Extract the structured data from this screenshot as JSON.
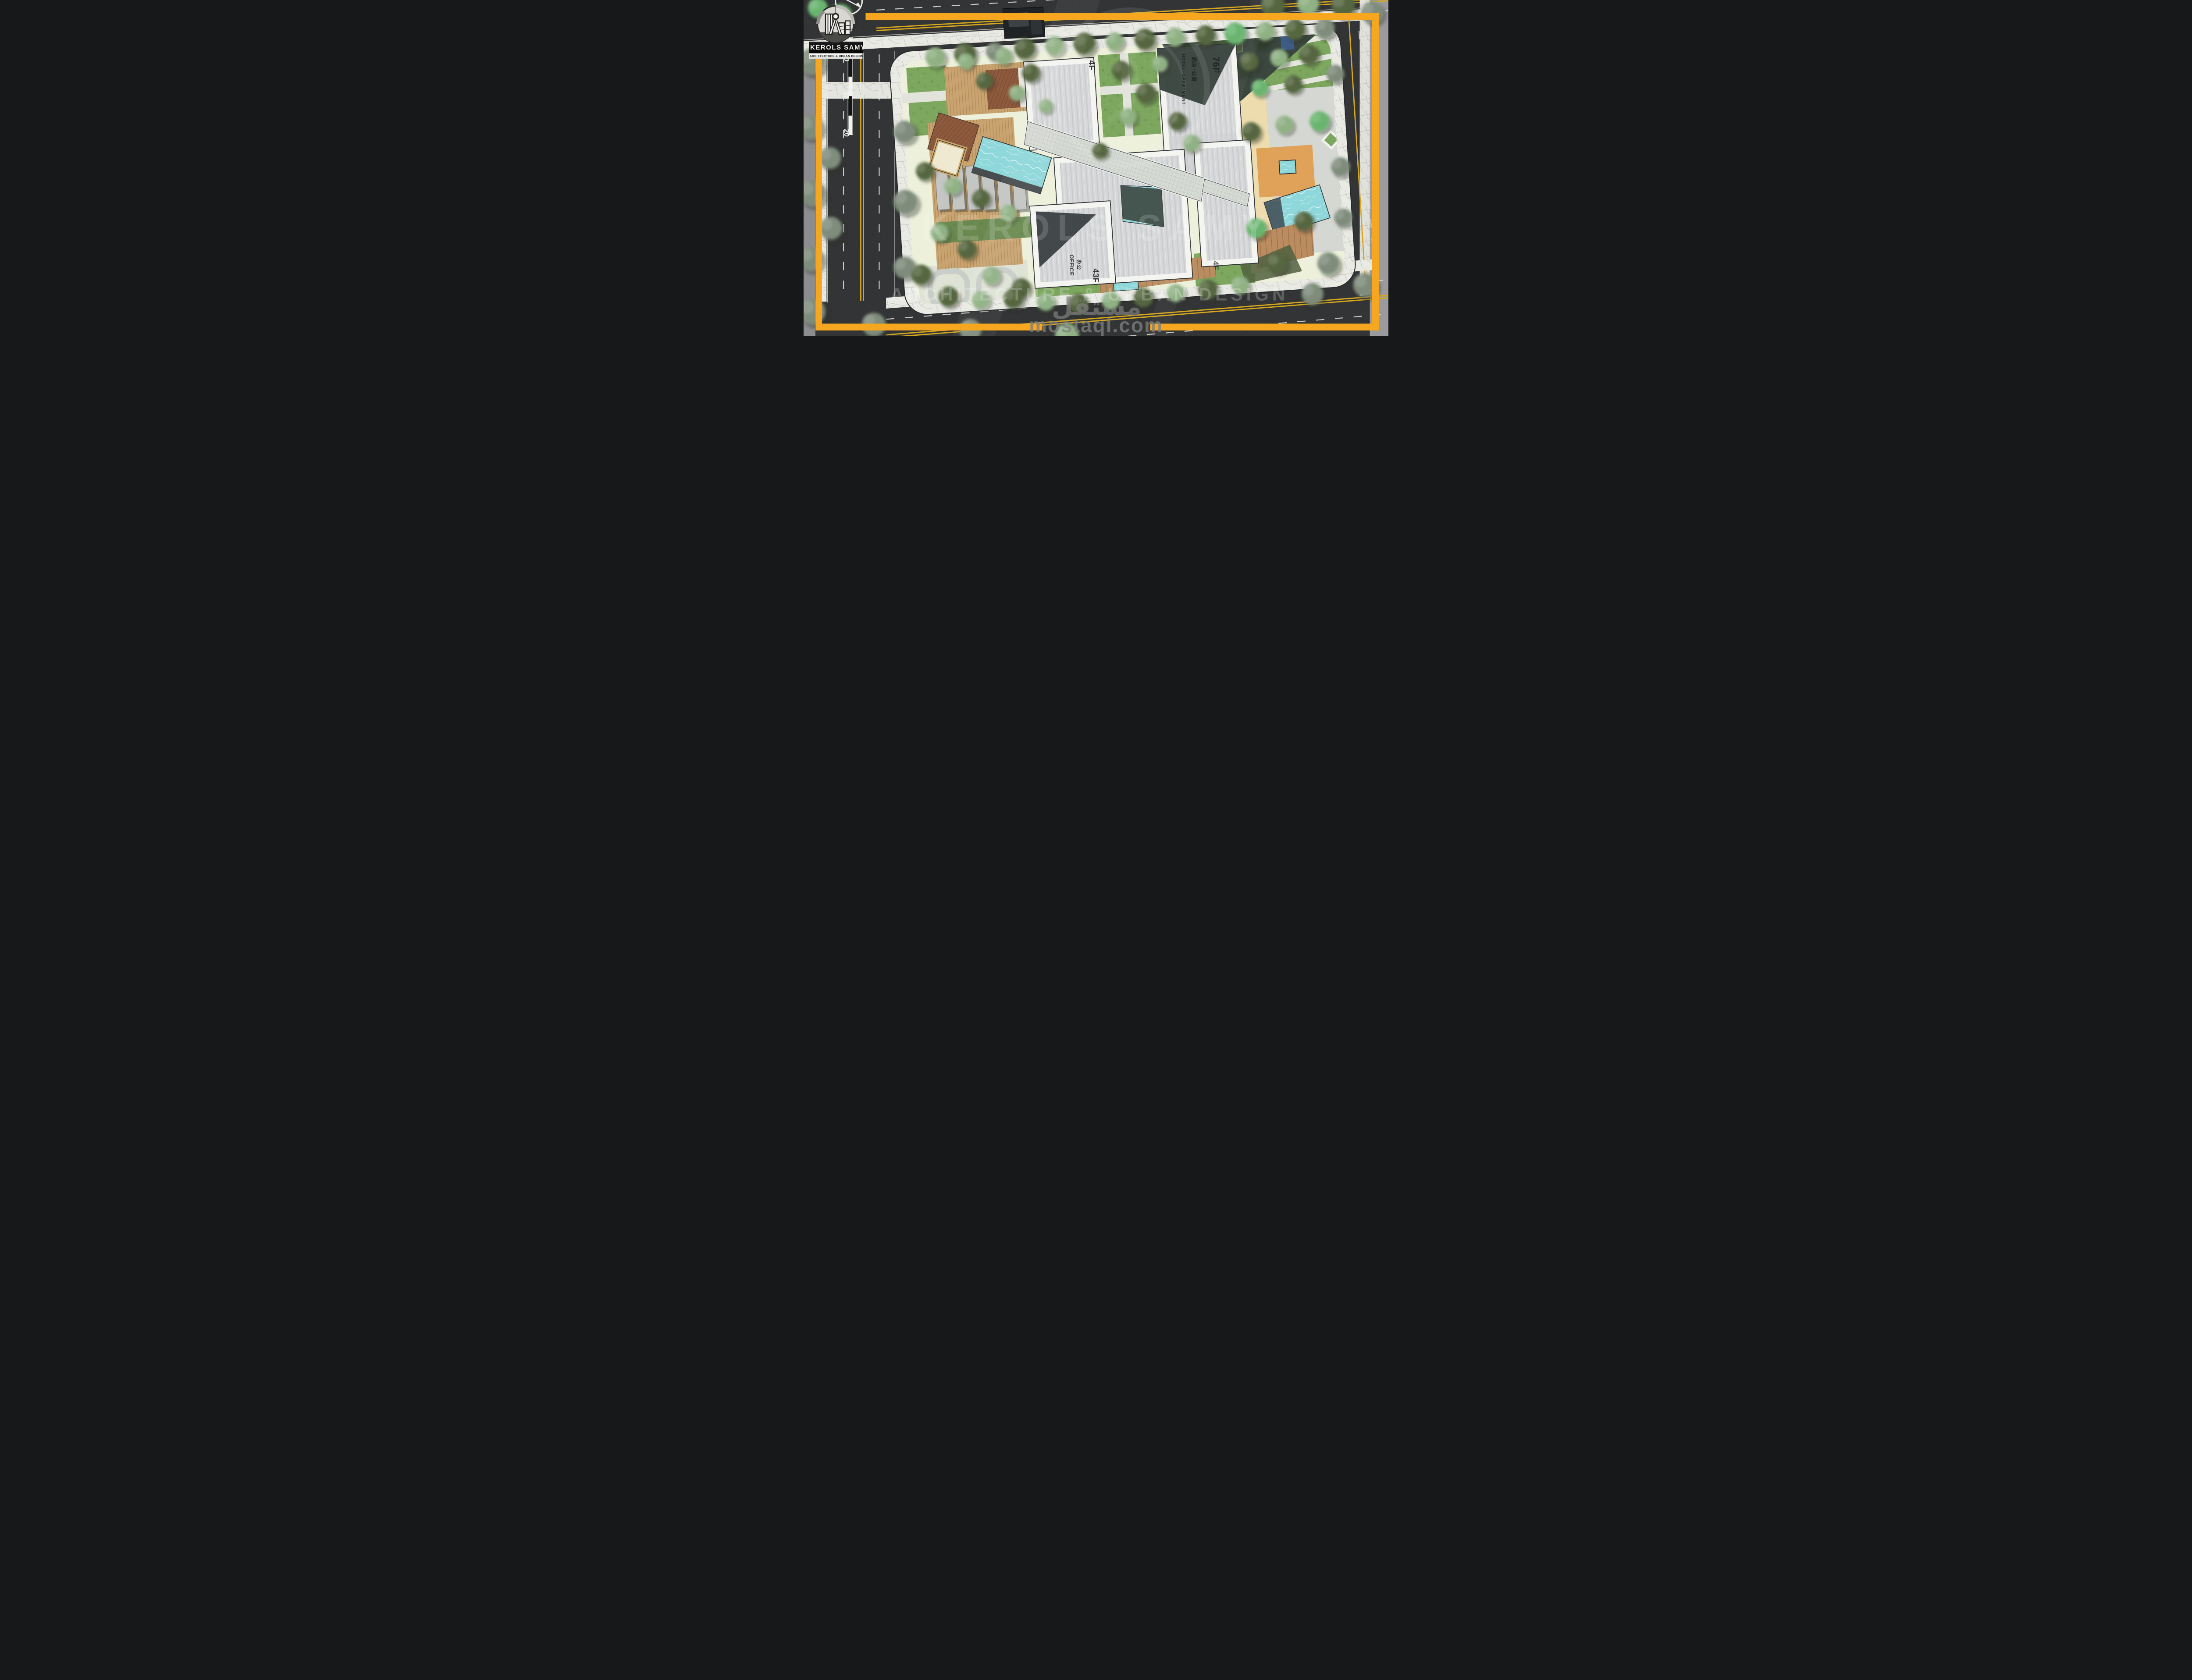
{
  "title": "Mixed-use masterplan site plan rendering",
  "logo": {
    "name": "KEROLS SAMY",
    "tagline": "ARCHITECTURE & URBAN DESIGN"
  },
  "scale_bar": {
    "ticks": [
      "10",
      "15",
      "20"
    ]
  },
  "buildings": {
    "retail_north": {
      "floors": "4F"
    },
    "hotel_apartment": {
      "floors": "76F",
      "use_en": "HOTEL+APARTMENT",
      "use_zh": "酒店+公寓"
    },
    "office": {
      "floors": "43F",
      "use_en": "OFFICE",
      "use_zh": "办公"
    },
    "east_podium": {
      "floors": "4F"
    }
  },
  "watermarks": {
    "brand": "KEROLS SAMY",
    "brand_tagline": "ARCHITECTURE & URBAN DESIGN",
    "marketplace_ar": "مستقل",
    "marketplace_url": "mostaql.com"
  },
  "theme": {
    "accent_orange": "#F7A71F",
    "asphalt": "#2A2C2D",
    "site_ground": "#EDF1DB",
    "sidewalk": "#E9EAE4",
    "grass": "#7DA75F",
    "hedge": "#55663F",
    "water": "#8ED7DA",
    "roof_gray": "#D6D7D8",
    "dark_tower": "#3A463E",
    "wood_tan": "#C9A470",
    "wood_red": "#8E5A3E",
    "sand": "#ECDCAE",
    "sand_orange": "#E0A258",
    "road_yellow": "#D7A81E",
    "marking_white": "#D8D8D4"
  }
}
